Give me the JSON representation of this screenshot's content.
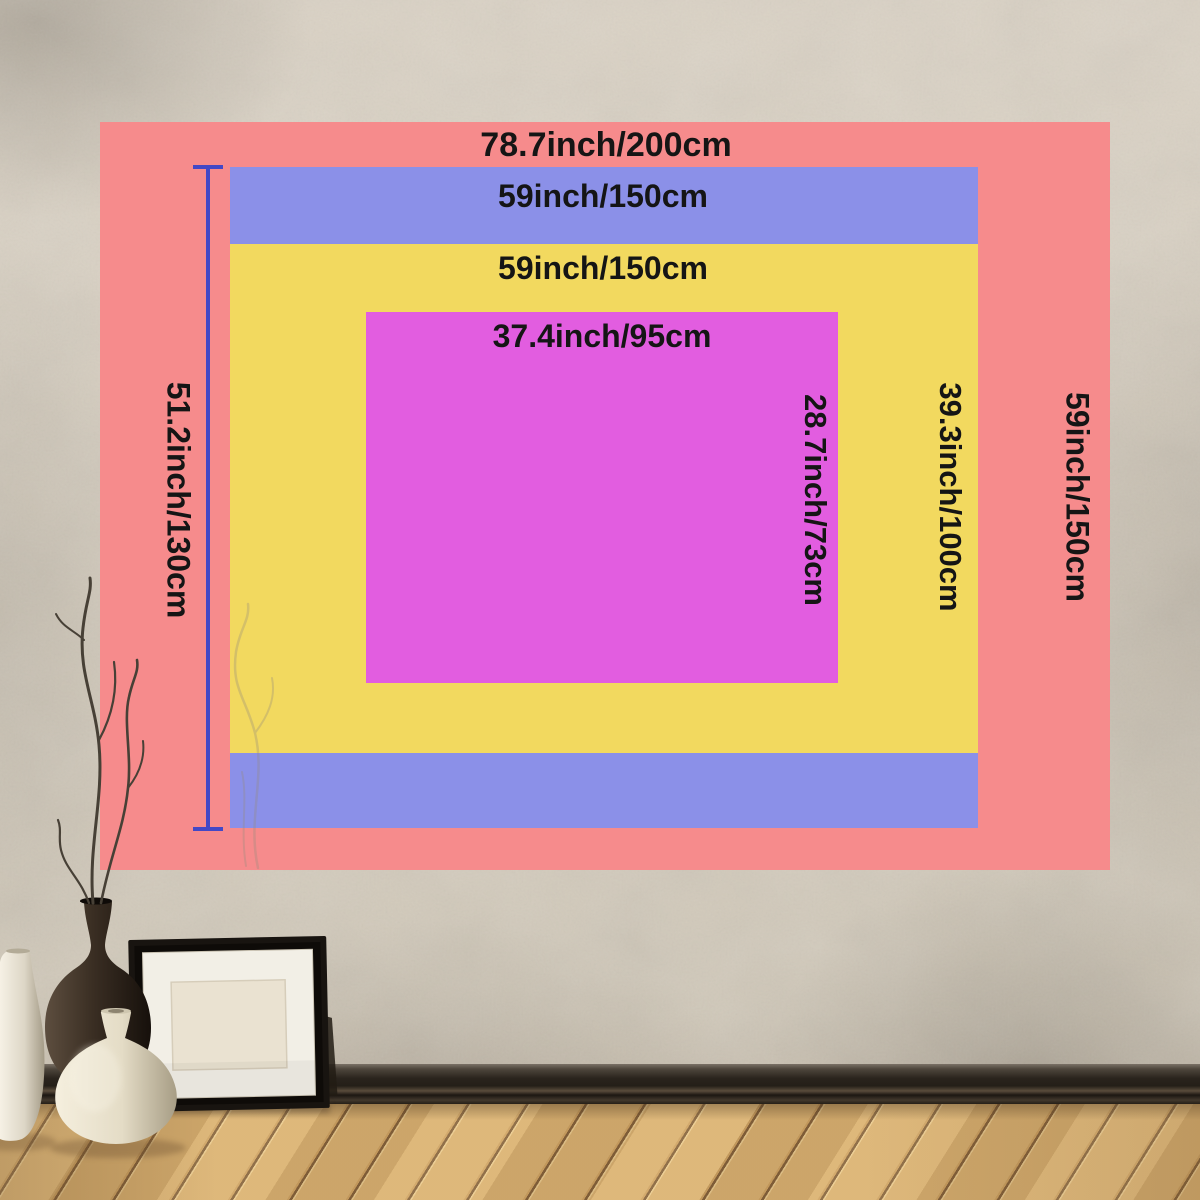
{
  "size_chart": {
    "ruler_color": "#4348c6",
    "text_color": "#151515",
    "layers": [
      {
        "id": "outer-pink",
        "color": "#f68b8c",
        "width_label": "78.7inch/200cm",
        "height_label": "59inch/150cm"
      },
      {
        "id": "middle-blue",
        "color": "#8b90e8",
        "width_label": "59inch/150cm",
        "height_label": "51.2inch/130cm"
      },
      {
        "id": "yellow",
        "color": "#f2d95f",
        "width_label": "59inch/150cm",
        "height_label": "39.3inch/100cm"
      },
      {
        "id": "inner-magenta",
        "color": "#e25de0",
        "width_label": "37.4inch/95cm",
        "height_label": "28.7inch/73cm"
      }
    ]
  }
}
